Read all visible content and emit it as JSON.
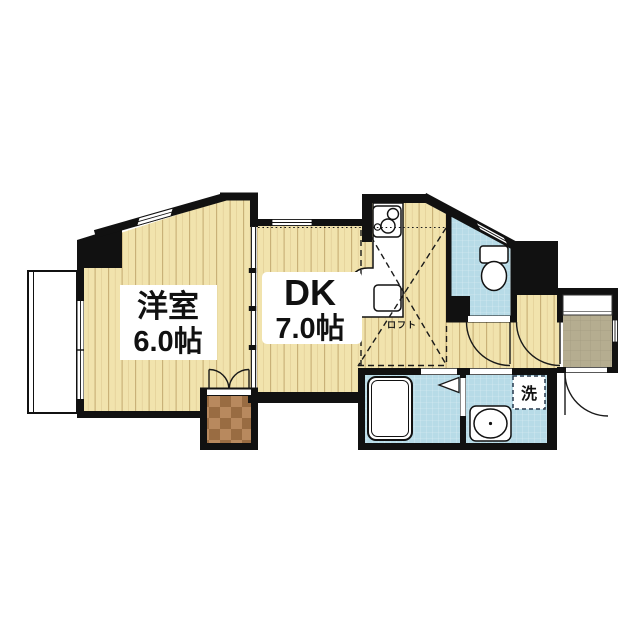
{
  "floorplan": {
    "type": "Japanese 1DK apartment floor plan",
    "labels": {
      "western_room_name": "洋室",
      "western_room_size": "6.0帖",
      "dk_name": "DK",
      "dk_size": "7.0帖",
      "loft": "ロフト",
      "laundry": "洗"
    },
    "colors": {
      "wall": "#111111",
      "wood_floor": "#f1e3ad",
      "wet_area": "#b7dbe7",
      "entrance_tile": "#b5ad90",
      "closet_floor": "#b07c4c",
      "background": "#ffffff"
    }
  }
}
